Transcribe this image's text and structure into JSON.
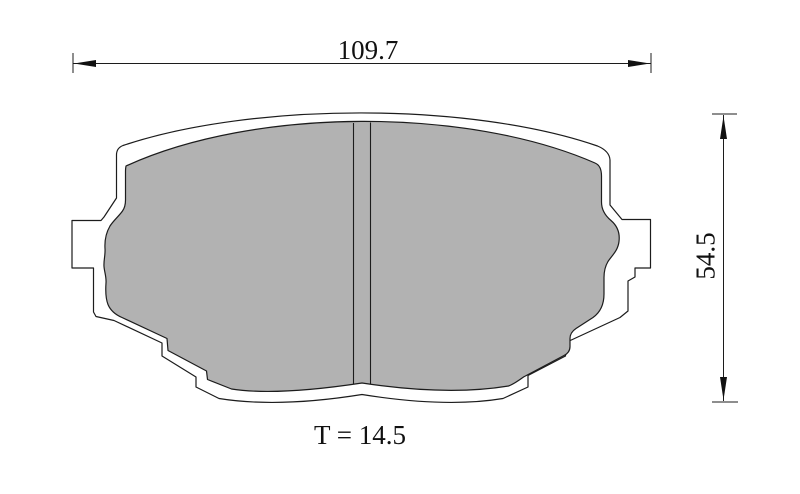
{
  "canvas": {
    "background": "#ffffff"
  },
  "colors": {
    "friction_fill": "#b2b2b2",
    "backplate_fill": "#ffffff",
    "outline": "#1c1c1c",
    "dimension_line": "#1c1c1c",
    "arrow_fill": "#111111",
    "label_text": "#111111"
  },
  "labels": {
    "width": "109.7",
    "height": "54.5",
    "thickness": "T = 14.5"
  }
}
